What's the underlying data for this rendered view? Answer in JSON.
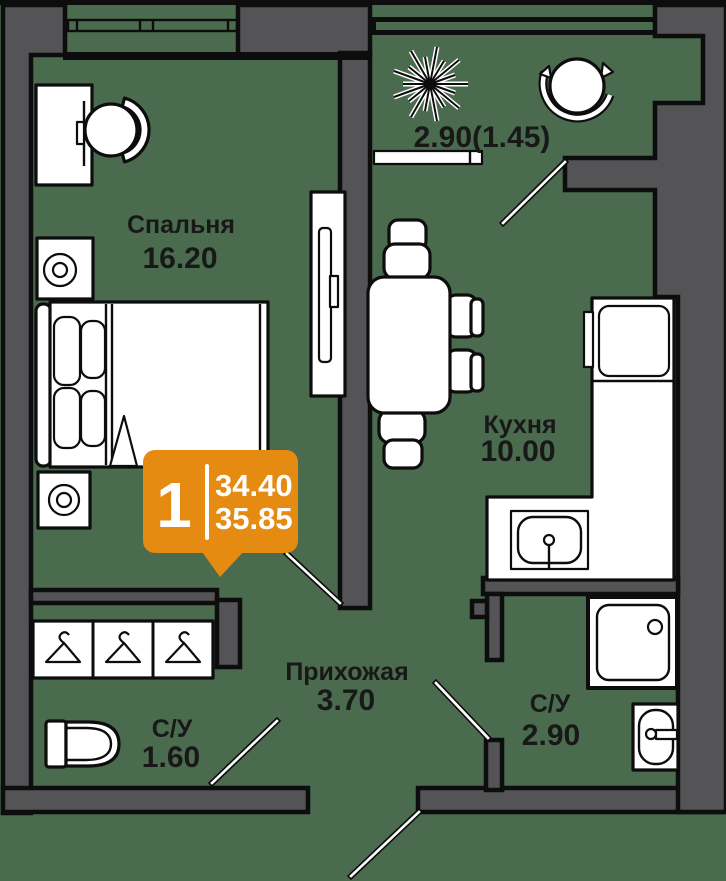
{
  "rooms": {
    "bedroom": {
      "name": "Спальня",
      "area": "16.20"
    },
    "kitchen": {
      "name": "Кухня",
      "area": "10.00"
    },
    "hallway": {
      "name": "Прихожая",
      "area": "3.70"
    },
    "bathroom_small": {
      "name": "С/У",
      "area": "1.60"
    },
    "bathroom_large": {
      "name": "С/У",
      "area": "2.90"
    },
    "balcony": {
      "area": "2.90(1.45)"
    }
  },
  "badge": {
    "rooms_count": "1",
    "living_area": "34.40",
    "total_area": "35.85"
  },
  "colors": {
    "background": "#4A6B4E",
    "wall": "#545356",
    "outline": "#0D0D0D",
    "text": "#181818",
    "badge": "#E58B11"
  },
  "icons": [
    "window",
    "balcony-glazing",
    "door-swing",
    "bed",
    "desk",
    "office-chair",
    "nightstand-lamp",
    "wardrobe",
    "dining-table",
    "chair",
    "kitchen-counter",
    "fridge",
    "kitchen-sink",
    "plant",
    "tub-chair",
    "hanger",
    "toilet",
    "shower",
    "washbasin"
  ]
}
